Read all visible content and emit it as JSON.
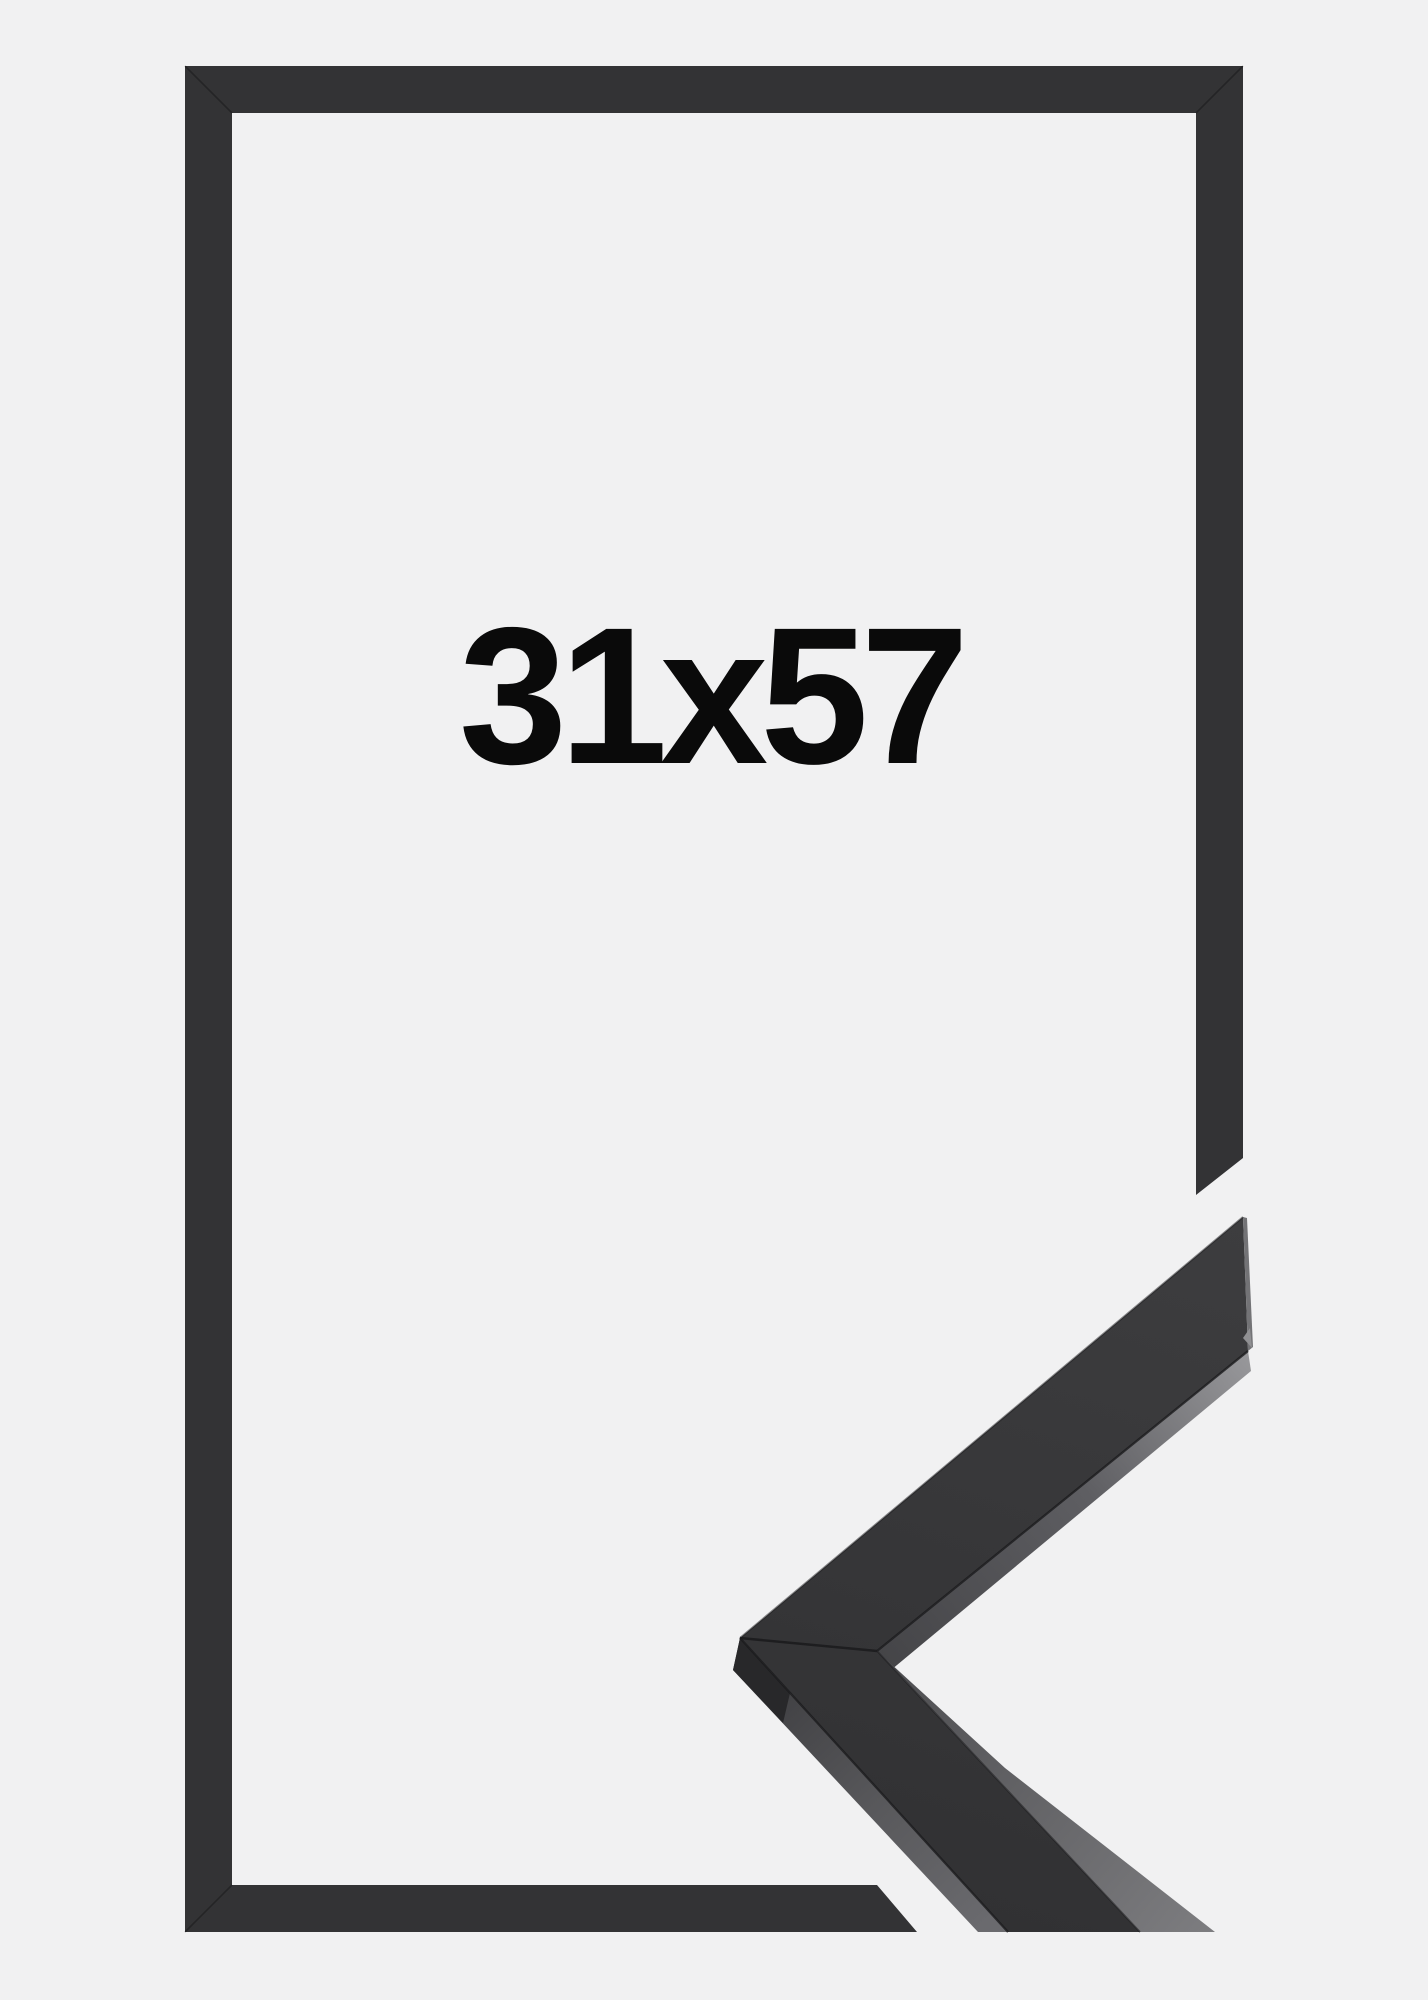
{
  "product": {
    "size_label": "31x57",
    "image_kind": "frame-size-product-photo",
    "frame_style": "thin matte black wooden frame",
    "views": {
      "main": "front view of empty black frame with size printed inside",
      "detail": "close-up corner cut of the moulding profile overlapping bottom right"
    }
  },
  "colors": {
    "background": "#f1f1f2",
    "frame": "#333335",
    "sample_top": "#3a3a3c",
    "sample_top_deep": "#303032",
    "side_light": "#98989b",
    "side_mid": "#68686c",
    "side_dark": "#454548",
    "corner_facet": "#28282a",
    "end_cut": "#737376",
    "end_cut_highlight": "#909093",
    "seam": "#1a1a1c",
    "label_text": "#0a0a0a"
  }
}
